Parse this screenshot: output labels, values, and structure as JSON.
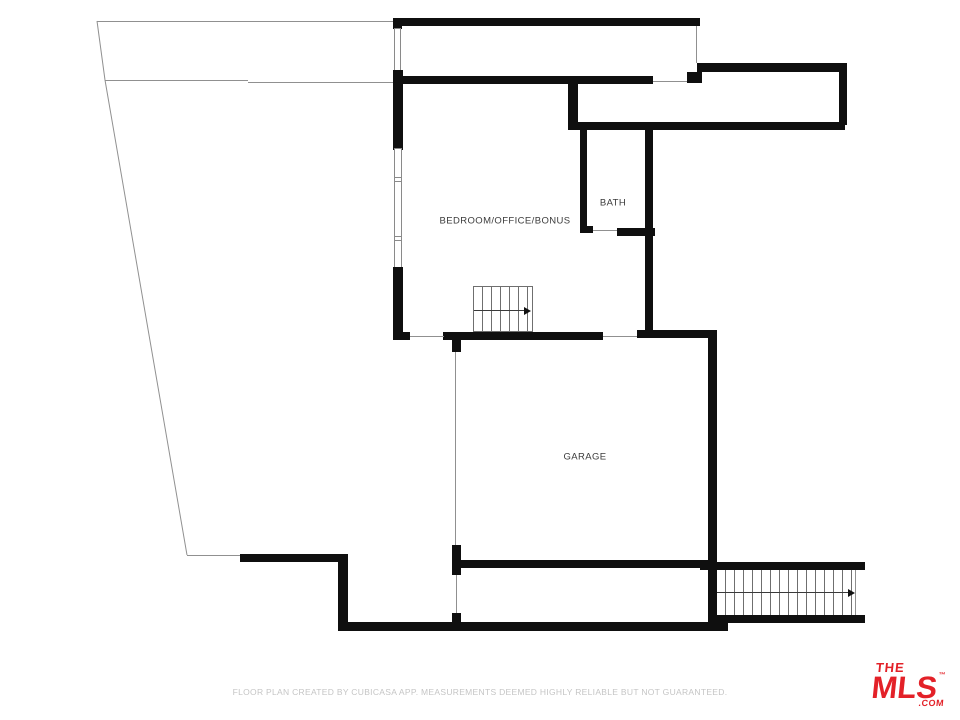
{
  "title": "Floor plan",
  "rooms": {
    "bedroom": {
      "label": "BEDROOM/OFFICE/BONUS"
    },
    "bath": {
      "label": "BATH"
    },
    "garage": {
      "label": "GARAGE"
    }
  },
  "stairs": {
    "upper": {
      "direction": "right"
    },
    "lower": {
      "direction": "right"
    }
  },
  "footer": {
    "disclaimer": "FLOOR PLAN CREATED BY CUBICASA APP. MEASUREMENTS DEEMED HIGHLY RELIABLE BUT NOT GUARANTEED."
  },
  "logo": {
    "line1": "THE",
    "line2": "MLS",
    "trademark": "™",
    "suffix": ".COM"
  },
  "colors": {
    "wall": "#0f0f0f",
    "thin_line": "#909090",
    "room_label": "#3b3b3b",
    "disclaimer_text": "#c5c5c5",
    "logo_red": "#e32128"
  }
}
